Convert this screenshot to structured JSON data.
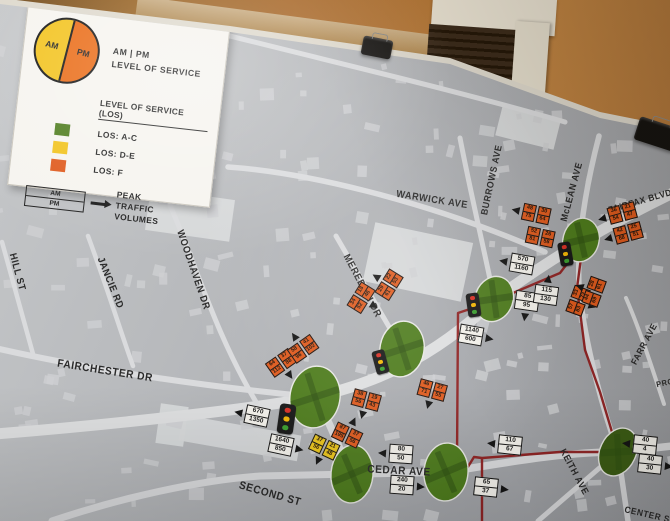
{
  "legend": {
    "pie": {
      "am_label": "AM",
      "pm_label": "PM",
      "am_color": "#f2c31d",
      "pm_color": "#ea6a14"
    },
    "pie_caption_line1": "AM | PM",
    "pie_caption_line2": "LEVEL OF SERVICE",
    "los_heading": "LEVEL OF SERVICE (LOS)",
    "items": [
      {
        "label": "LOS: A-C",
        "color": "#4e7c1d"
      },
      {
        "label": "LOS: D-E",
        "color": "#f2c31d"
      },
      {
        "label": "LOS: F",
        "color": "#df5a1d"
      }
    ],
    "volume_key": {
      "top": "AM",
      "bottom": "PM",
      "caption_line1": "PEAK",
      "caption_line2": "TRAFFIC VOLUMES"
    }
  },
  "map": {
    "colors": {
      "los_a_c": "#4e7c1d",
      "los_d_e": "#f2c31d",
      "los_f": "#df5a1d",
      "route_red": "#8e1d1d",
      "board_gray": "#b3b5b8",
      "wall_orange": "#a96a2c"
    },
    "street_labels": [
      {
        "text": "SCOTT DR",
        "x": 186,
        "y": 21,
        "rot": 10,
        "size": 11
      },
      {
        "text": "WARWICK AVE",
        "x": 432,
        "y": 200,
        "rot": 9,
        "size": 10
      },
      {
        "text": "BURROWS AVE",
        "x": 492,
        "y": 180,
        "rot": -78,
        "size": 9.5
      },
      {
        "text": "McLEAN AVE",
        "x": 572,
        "y": 192,
        "rot": -75,
        "size": 9.5
      },
      {
        "text": "FAIRFAX BLVD",
        "x": 640,
        "y": 201,
        "rot": -16,
        "size": 9
      },
      {
        "text": "FARR AVE",
        "x": 644,
        "y": 344,
        "rot": -62,
        "size": 9
      },
      {
        "text": "MEREDITH DR",
        "x": 362,
        "y": 286,
        "rot": 62,
        "size": 10
      },
      {
        "text": "WOODHAVEN DR",
        "x": 193,
        "y": 270,
        "rot": 71,
        "size": 10
      },
      {
        "text": "JANCIE RD",
        "x": 110,
        "y": 283,
        "rot": 68,
        "size": 10
      },
      {
        "text": "HILL ST",
        "x": 17,
        "y": 272,
        "rot": 75,
        "size": 10
      },
      {
        "text": "FAIRCHESTER DR",
        "x": 105,
        "y": 371,
        "rot": 9,
        "size": 11
      },
      {
        "text": "CEDAR AVE",
        "x": 399,
        "y": 471,
        "rot": 3,
        "size": 11
      },
      {
        "text": "SECOND ST",
        "x": 270,
        "y": 494,
        "rot": 16,
        "size": 11
      },
      {
        "text": "KEITH AVE",
        "x": 574,
        "y": 472,
        "rot": 62,
        "size": 9.5
      },
      {
        "text": "CENTER ST",
        "x": 650,
        "y": 515,
        "rot": 13,
        "size": 9
      },
      {
        "text": "PRO",
        "x": 665,
        "y": 383,
        "rot": -12,
        "size": 8
      }
    ],
    "intersections": [
      {
        "x": 494,
        "y": 299,
        "rx": 19,
        "ry": 23,
        "rot": 20
      },
      {
        "x": 581,
        "y": 240,
        "rx": 18,
        "ry": 22,
        "rot": 15
      },
      {
        "x": 402,
        "y": 349,
        "rx": 22,
        "ry": 28,
        "rot": 10
      },
      {
        "x": 315,
        "y": 397,
        "rx": 25,
        "ry": 31,
        "rot": 10
      },
      {
        "x": 352,
        "y": 474,
        "rx": 21,
        "ry": 29,
        "rot": 5
      },
      {
        "x": 446,
        "y": 472,
        "rx": 22,
        "ry": 29,
        "rot": 5
      },
      {
        "x": 618,
        "y": 452,
        "rx": 18,
        "ry": 25,
        "rot": 25,
        "dark": true
      }
    ],
    "traffic_lights": [
      {
        "x": 380,
        "y": 362,
        "rot": -15,
        "scale": 1
      },
      {
        "x": 286,
        "y": 419,
        "rot": 8,
        "scale": 1.25
      },
      {
        "x": 565,
        "y": 254,
        "rot": -10,
        "scale": 1
      },
      {
        "x": 473,
        "y": 305,
        "rot": -8,
        "scale": 1
      }
    ],
    "volume_boxes": [
      {
        "type": "white",
        "x": 257,
        "y": 416,
        "rot": 12,
        "arrow": "left",
        "values": [
          "670",
          "1350"
        ]
      },
      {
        "type": "white",
        "x": 281,
        "y": 445,
        "rot": 12,
        "arrow": "right",
        "values": [
          "1640",
          "850"
        ]
      },
      {
        "type": "white",
        "x": 401,
        "y": 454,
        "rot": 4,
        "arrow": "left",
        "values": [
          "80",
          "50"
        ]
      },
      {
        "type": "white",
        "x": 402,
        "y": 485,
        "rot": 4,
        "arrow": "right",
        "values": [
          "240",
          "20"
        ]
      },
      {
        "type": "white",
        "x": 510,
        "y": 445,
        "rot": 6,
        "arrow": "left",
        "values": [
          "110",
          "67"
        ]
      },
      {
        "type": "white",
        "x": 486,
        "y": 487,
        "rot": 6,
        "arrow": "right",
        "values": [
          "65",
          "37"
        ]
      },
      {
        "type": "white",
        "x": 645,
        "y": 445,
        "rot": 6,
        "arrow": "left",
        "values": [
          "40",
          "4"
        ]
      },
      {
        "type": "white",
        "x": 650,
        "y": 464,
        "rot": 6,
        "arrow": "right",
        "values": [
          "40",
          "30"
        ]
      },
      {
        "type": "white",
        "x": 522,
        "y": 264,
        "rot": 10,
        "arrow": "left",
        "values": [
          "570",
          "1160"
        ]
      },
      {
        "type": "white",
        "x": 527,
        "y": 301,
        "rot": 8,
        "arrow": "down",
        "values": [
          "85",
          "95"
        ]
      },
      {
        "type": "white",
        "x": 546,
        "y": 295,
        "rot": 8,
        "arrow": "up",
        "values": [
          "115",
          "130"
        ]
      },
      {
        "type": "white",
        "x": 471,
        "y": 335,
        "rot": 10,
        "arrow": "right",
        "values": [
          "1140",
          "600"
        ]
      },
      {
        "type": "orange",
        "x": 281,
        "y": 363,
        "rot": -35,
        "arrow": "down",
        "values": [
          "64",
          "112",
          "37",
          "88"
        ]
      },
      {
        "type": "orange",
        "x": 303,
        "y": 349,
        "rot": -35,
        "arrow": "up",
        "values": [
          "58",
          "96",
          "41",
          "102"
        ]
      },
      {
        "type": "orange",
        "x": 361,
        "y": 298,
        "rot": -58,
        "arrow": "down",
        "values": [
          "34",
          "52",
          "18",
          "46"
        ]
      },
      {
        "type": "orange",
        "x": 389,
        "y": 285,
        "rot": -58,
        "arrow": "up",
        "values": [
          "29",
          "61",
          "22",
          "53"
        ]
      },
      {
        "type": "orange",
        "x": 536,
        "y": 214,
        "rot": 12,
        "arrow": "left",
        "values": [
          "48",
          "75",
          "30",
          "64"
        ]
      },
      {
        "type": "orange",
        "x": 540,
        "y": 237,
        "rot": 12,
        "arrow": null,
        "values": [
          "52",
          "81",
          "26",
          "58"
        ]
      },
      {
        "type": "orange",
        "x": 622,
        "y": 213,
        "rot": -15,
        "arrow": "left",
        "values": [
          "36",
          "54",
          "21",
          "47"
        ]
      },
      {
        "type": "orange",
        "x": 628,
        "y": 233,
        "rot": -15,
        "arrow": "left",
        "values": [
          "42",
          "68",
          "25",
          "51"
        ]
      },
      {
        "type": "orange",
        "x": 578,
        "y": 301,
        "rot": -70,
        "arrow": "down",
        "values": [
          "57",
          "83",
          "33",
          "72"
        ]
      },
      {
        "type": "orange",
        "x": 594,
        "y": 292,
        "rot": -70,
        "arrow": "up",
        "values": [
          "44",
          "69",
          "28",
          "61"
        ]
      },
      {
        "type": "orange",
        "x": 366,
        "y": 400,
        "rot": 15,
        "arrow": "down",
        "values": [
          "38",
          "56",
          "19",
          "43"
        ]
      },
      {
        "type": "orange",
        "x": 432,
        "y": 390,
        "rot": 15,
        "arrow": "down",
        "values": [
          "46",
          "71",
          "27",
          "55"
        ]
      },
      {
        "type": "orange",
        "x": 347,
        "y": 435,
        "rot": 25,
        "arrow": "up",
        "values": [
          "87",
          "195",
          "37",
          "56"
        ]
      },
      {
        "type": "yellow",
        "x": 324,
        "y": 447,
        "rot": 25,
        "arrow": "down",
        "values": [
          "37",
          "56",
          "21",
          "48"
        ]
      }
    ]
  }
}
